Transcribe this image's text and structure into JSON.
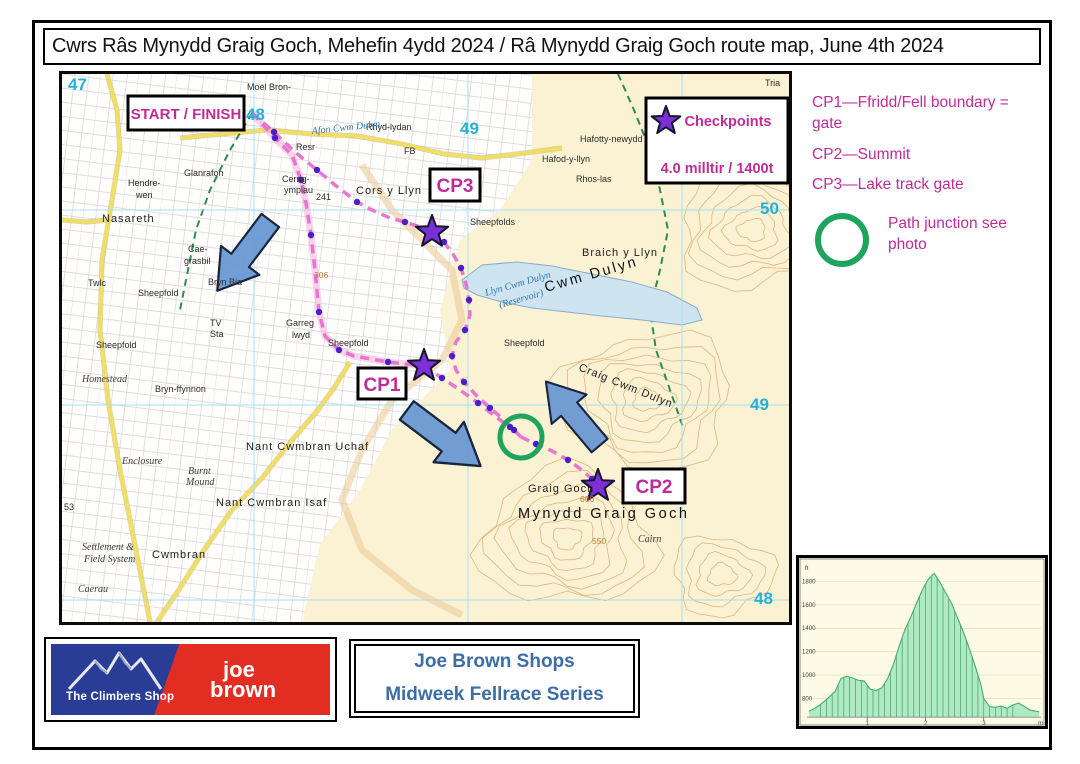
{
  "page": {
    "title": "Cwrs Râs Mynydd Graig Goch, Mehefin 4ydd 2024 / Râ Mynydd Graig Goch route map, June 4th 2024"
  },
  "map": {
    "start_finish_label": "START / FINISH",
    "cp1_label": "CP1",
    "cp2_label": "CP2",
    "cp3_label": "CP3",
    "legend": {
      "title": "Checkpoints",
      "distance": "4.0 milltir / 1400t"
    },
    "colors": {
      "magenta": "#c02b97",
      "star_purple": "#7c2fd6",
      "junction_green": "#1ea45c",
      "arrow_blue": "#6b99d4",
      "grid_cyan": "#25b2d9",
      "route_pink": "#e86fd0"
    },
    "grid_numbers": [
      {
        "t": "47",
        "x": 6,
        "y": 16
      },
      {
        "t": "48",
        "x": 184,
        "y": 46
      },
      {
        "t": "49",
        "x": 398,
        "y": 60
      },
      {
        "t": "50",
        "x": 698,
        "y": 140
      },
      {
        "t": "49",
        "x": 688,
        "y": 336
      },
      {
        "t": "48",
        "x": 692,
        "y": 530
      }
    ],
    "labels": [
      {
        "t": "Moel Bron-",
        "x": 185,
        "y": 16,
        "c": "pl"
      },
      {
        "t": "Rhyd-lydan",
        "x": 304,
        "y": 56,
        "c": "pl"
      },
      {
        "t": "Fron-Dulyn",
        "x": 638,
        "y": 59,
        "c": "pl"
      },
      {
        "t": "Hafotty-newydd",
        "x": 518,
        "y": 68,
        "c": "pl"
      },
      {
        "t": "Hafod-y-llyn",
        "x": 480,
        "y": 88,
        "c": "pl"
      },
      {
        "t": "Rhos-las",
        "x": 514,
        "y": 108,
        "c": "pl"
      },
      {
        "t": "Tria",
        "x": 703,
        "y": 12,
        "c": "pl"
      },
      {
        "t": "Cors y Llyn",
        "x": 294,
        "y": 120,
        "c": "pl2"
      },
      {
        "t": "Sheepfolds",
        "x": 408,
        "y": 151,
        "c": "pl"
      },
      {
        "t": "Afon Cwm Dulyn",
        "x": 250,
        "y": 60,
        "c": "water",
        "r": -6
      },
      {
        "t": "Resr",
        "x": 234,
        "y": 76,
        "c": "pl"
      },
      {
        "t": "FB",
        "x": 342,
        "y": 80,
        "c": "pl"
      },
      {
        "t": "Cwm Dulyn",
        "x": 484,
        "y": 218,
        "c": "big",
        "r": -16
      },
      {
        "t": "Llyn Cwm Dulyn",
        "x": 424,
        "y": 222,
        "c": "water",
        "r": -16
      },
      {
        "t": "(Reservoir)",
        "x": 438,
        "y": 234,
        "c": "water",
        "r": -16
      },
      {
        "t": "Braich y Llyn",
        "x": 520,
        "y": 182,
        "c": "pl2"
      },
      {
        "t": "Sheepfold",
        "x": 442,
        "y": 272,
        "c": "pl"
      },
      {
        "t": "Craig Cwm Dulyn",
        "x": 516,
        "y": 296,
        "c": "pl2",
        "r": 22
      },
      {
        "t": "Graig Goch",
        "x": 466,
        "y": 418,
        "c": "pl2"
      },
      {
        "t": "Mynydd Graig Goch",
        "x": 456,
        "y": 444,
        "c": "big"
      },
      {
        "t": "Cairn",
        "x": 576,
        "y": 468,
        "c": "gothic"
      },
      {
        "t": "Nasareth",
        "x": 40,
        "y": 148,
        "c": "pl2"
      },
      {
        "t": "Hendre-",
        "x": 66,
        "y": 112,
        "c": "pl"
      },
      {
        "t": "wen",
        "x": 74,
        "y": 124,
        "c": "pl"
      },
      {
        "t": "Glanrafon",
        "x": 122,
        "y": 102,
        "c": "pl"
      },
      {
        "t": "Cerrig-",
        "x": 220,
        "y": 108,
        "c": "pl"
      },
      {
        "t": "ympiau",
        "x": 222,
        "y": 119,
        "c": "pl"
      },
      {
        "t": "241",
        "x": 254,
        "y": 126,
        "c": "pl"
      },
      {
        "t": "Cae-",
        "x": 126,
        "y": 178,
        "c": "pl"
      },
      {
        "t": "grasbil",
        "x": 122,
        "y": 190,
        "c": "pl"
      },
      {
        "t": "Twlc",
        "x": 26,
        "y": 212,
        "c": "pl"
      },
      {
        "t": "Sheepfold",
        "x": 76,
        "y": 222,
        "c": "pl"
      },
      {
        "t": "Bryn Bia",
        "x": 146,
        "y": 211,
        "c": "pl"
      },
      {
        "t": "TV",
        "x": 148,
        "y": 252,
        "c": "pl"
      },
      {
        "t": "Sta",
        "x": 148,
        "y": 263,
        "c": "pl"
      },
      {
        "t": "306",
        "x": 252,
        "y": 204,
        "c": "orange"
      },
      {
        "t": "Garreg",
        "x": 224,
        "y": 252,
        "c": "pl"
      },
      {
        "t": "lwyd",
        "x": 230,
        "y": 264,
        "c": "pl"
      },
      {
        "t": "Sheepfold",
        "x": 266,
        "y": 272,
        "c": "pl"
      },
      {
        "t": "Sheepfold",
        "x": 34,
        "y": 274,
        "c": "pl"
      },
      {
        "t": "Bryn-ffynnon",
        "x": 93,
        "y": 318,
        "c": "pl"
      },
      {
        "t": "Homestead",
        "x": 20,
        "y": 308,
        "c": "gothic"
      },
      {
        "t": "Enclosure",
        "x": 60,
        "y": 390,
        "c": "gothic"
      },
      {
        "t": "Burnt",
        "x": 126,
        "y": 400,
        "c": "gothic"
      },
      {
        "t": "Mound",
        "x": 124,
        "y": 411,
        "c": "gothic"
      },
      {
        "t": "Nant Cwmbran Uchaf",
        "x": 184,
        "y": 376,
        "c": "pl2"
      },
      {
        "t": "Nant Cwmbran Isaf",
        "x": 154,
        "y": 432,
        "c": "pl2"
      },
      {
        "t": "Settlement &",
        "x": 20,
        "y": 476,
        "c": "gothic"
      },
      {
        "t": "Field System",
        "x": 22,
        "y": 488,
        "c": "gothic"
      },
      {
        "t": "Cwmbran",
        "x": 90,
        "y": 484,
        "c": "pl2"
      },
      {
        "t": "Caerau",
        "x": 16,
        "y": 518,
        "c": "gothic"
      },
      {
        "t": "550",
        "x": 530,
        "y": 470,
        "c": "orange"
      },
      {
        "t": "606",
        "x": 518,
        "y": 428,
        "c": "orange"
      },
      {
        "t": "53",
        "x": 2,
        "y": 436,
        "c": "pl"
      }
    ],
    "route": {
      "start_to_cp1": [
        [
          190,
          39
        ],
        [
          213,
          64
        ],
        [
          230,
          81
        ],
        [
          239,
          106
        ],
        [
          244,
          129
        ],
        [
          249,
          161
        ],
        [
          253,
          196
        ],
        [
          257,
          238
        ],
        [
          263,
          262
        ],
        [
          277,
          276
        ],
        [
          292,
          282
        ],
        [
          326,
          288
        ],
        [
          362,
          292
        ]
      ],
      "start_to_cp3": [
        [
          190,
          39
        ],
        [
          212,
          58
        ],
        [
          233,
          78
        ],
        [
          255,
          96
        ],
        [
          273,
          111
        ],
        [
          295,
          128
        ],
        [
          310,
          136
        ],
        [
          328,
          144
        ],
        [
          343,
          148
        ],
        [
          358,
          153
        ],
        [
          370,
          158
        ]
      ],
      "cp3_to_junction": [
        [
          370,
          158
        ],
        [
          382,
          168
        ],
        [
          391,
          180
        ],
        [
          399,
          194
        ],
        [
          404,
          210
        ],
        [
          407,
          226
        ],
        [
          408,
          241
        ],
        [
          403,
          256
        ],
        [
          394,
          268
        ],
        [
          390,
          282
        ],
        [
          394,
          296
        ],
        [
          402,
          308
        ],
        [
          414,
          321
        ],
        [
          428,
          334
        ],
        [
          442,
          346
        ],
        [
          452,
          356
        ],
        [
          459,
          363
        ]
      ],
      "cp1_to_junction": [
        [
          362,
          292
        ],
        [
          380,
          304
        ],
        [
          398,
          316
        ],
        [
          416,
          329
        ],
        [
          434,
          343
        ],
        [
          448,
          353
        ],
        [
          459,
          363
        ]
      ],
      "junction_to_cp2": [
        [
          459,
          363
        ],
        [
          474,
          370
        ],
        [
          490,
          377
        ],
        [
          506,
          386
        ],
        [
          520,
          396
        ],
        [
          530,
          405
        ],
        [
          536,
          412
        ]
      ]
    },
    "route_dots": [
      [
        213,
        64
      ],
      [
        239,
        106
      ],
      [
        249,
        161
      ],
      [
        257,
        238
      ],
      [
        277,
        276
      ],
      [
        326,
        288
      ],
      [
        212,
        58
      ],
      [
        255,
        96
      ],
      [
        295,
        128
      ],
      [
        343,
        148
      ],
      [
        382,
        168
      ],
      [
        399,
        194
      ],
      [
        407,
        226
      ],
      [
        403,
        256
      ],
      [
        390,
        282
      ],
      [
        402,
        308
      ],
      [
        428,
        334
      ],
      [
        452,
        356
      ],
      [
        380,
        304
      ],
      [
        416,
        329
      ],
      [
        448,
        353
      ],
      [
        474,
        370
      ],
      [
        506,
        386
      ],
      [
        530,
        405
      ]
    ],
    "stars": [
      {
        "name": "cp3-star",
        "x": 370,
        "y": 158
      },
      {
        "name": "cp1-star",
        "x": 362,
        "y": 292
      },
      {
        "name": "cp2-star",
        "x": 536,
        "y": 412
      }
    ],
    "arrows": [
      {
        "x": 183,
        "y": 180,
        "angle": 127,
        "scale": 1.0
      },
      {
        "x": 380,
        "y": 363,
        "angle": 37,
        "scale": 1.05
      },
      {
        "x": 512,
        "y": 341,
        "angle": -130,
        "scale": 0.95
      }
    ],
    "junction_circle": {
      "x": 459,
      "y": 363,
      "r": 21
    }
  },
  "sidebar": {
    "cp_notes": [
      "CP1—Ffridd/Fell boundary = gate",
      "CP2—Summit",
      "CP3—Lake track gate"
    ],
    "junction_note": "Path junction see photo"
  },
  "sponsors": {
    "climbers_shop": "The Climbers Shop",
    "joe_line1": "joe",
    "joe_line2": "brown",
    "series_line1": "Joe Brown Shops",
    "series_line2": "Midweek Fellrace Series"
  },
  "chart_data": {
    "type": "area",
    "title": "Route elevation profile",
    "ylabel": "ft",
    "xlabel": "m",
    "yticks": [
      800,
      1000,
      1200,
      1400,
      1600,
      1800
    ],
    "xticks": [
      1,
      2,
      3
    ],
    "xlim": [
      0,
      3.95
    ],
    "ylim": [
      640,
      1900
    ],
    "x": [
      0,
      0.1,
      0.2,
      0.3,
      0.45,
      0.55,
      0.65,
      0.75,
      0.85,
      0.95,
      1.05,
      1.15,
      1.25,
      1.35,
      1.45,
      1.55,
      1.65,
      1.75,
      1.85,
      1.95,
      2.05,
      2.15,
      2.25,
      2.35,
      2.45,
      2.55,
      2.65,
      2.75,
      2.85,
      2.95,
      3.0,
      3.1,
      3.2,
      3.3,
      3.4,
      3.5,
      3.6,
      3.7,
      3.8,
      3.9,
      3.95
    ],
    "elevation_ft": [
      690,
      715,
      750,
      790,
      860,
      970,
      990,
      975,
      955,
      950,
      880,
      868,
      890,
      970,
      1090,
      1250,
      1390,
      1500,
      1620,
      1730,
      1820,
      1870,
      1790,
      1700,
      1610,
      1490,
      1370,
      1230,
      1080,
      920,
      800,
      730,
      725,
      735,
      715,
      745,
      760,
      730,
      700,
      690,
      685
    ]
  }
}
